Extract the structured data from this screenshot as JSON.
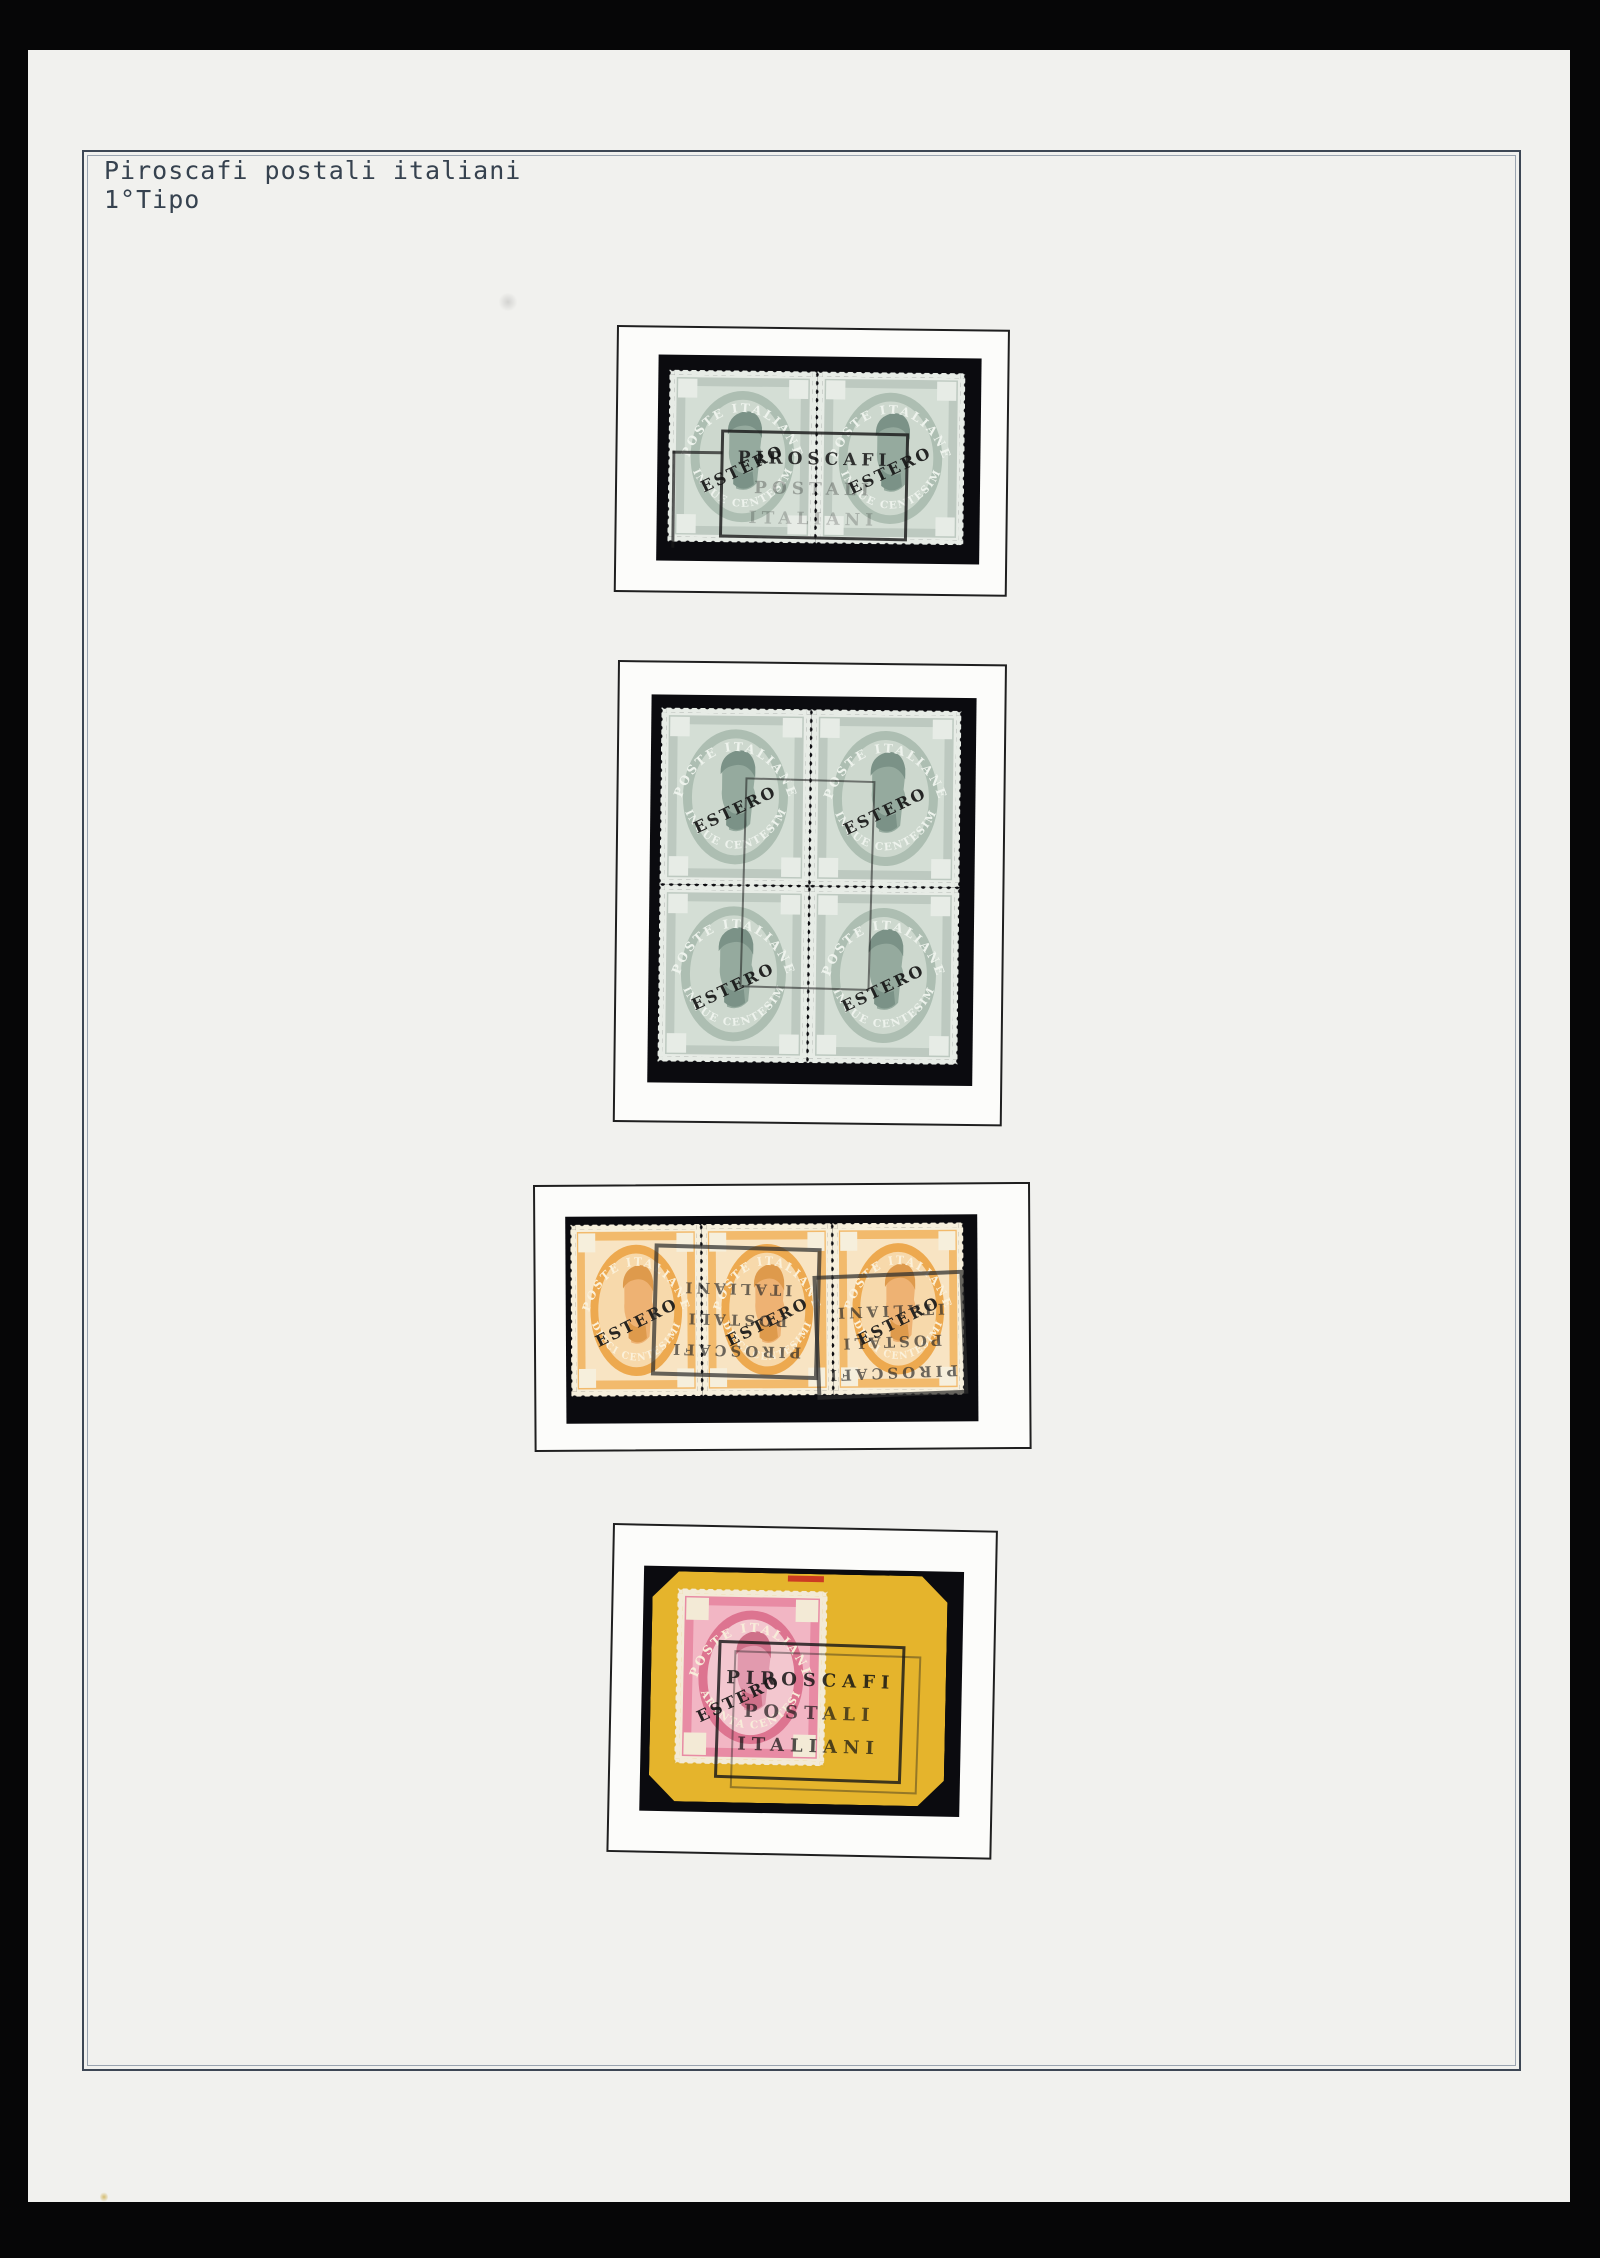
{
  "colors": {
    "scan-black": "#060607",
    "paper": "#f1f1ee",
    "rule-dark": "#3d4754",
    "rule-light": "#9aa4b0",
    "title-ink": "#36424f",
    "frame-line": "#1f1f1f",
    "frame-fill": "#fcfcfa",
    "mount": "#0b0b0f",
    "piece-yellow": "#e5b42c",
    "grey-stamp": "#bdc9c0",
    "orange-stamp": "#f2ba6c",
    "pink-stamp": "#e88ba4",
    "cancel-ink": "#232323"
  },
  "page": {
    "title_line1": "Piroscafi postali italiani",
    "title_line2": "1°Tipo"
  },
  "stamps": {
    "grey": {
      "top_text": "POSTE ITALIANE",
      "bottom_text": "CINQUE CENTESIMI",
      "overprint": "ESTERO"
    },
    "orange": {
      "top_text": "POSTE ITALIANE",
      "bottom_text": "DIECI CENTESIMI",
      "overprint": "ESTERO"
    },
    "pink": {
      "top_text": "POSTE ITALIANE",
      "bottom_text": "QUARANTA CENTESIMI",
      "overprint": "ESTERO"
    }
  },
  "cancel": {
    "line1": "PIROSCAFI",
    "line2": "POSTALI",
    "line3": "ITALIANI"
  }
}
